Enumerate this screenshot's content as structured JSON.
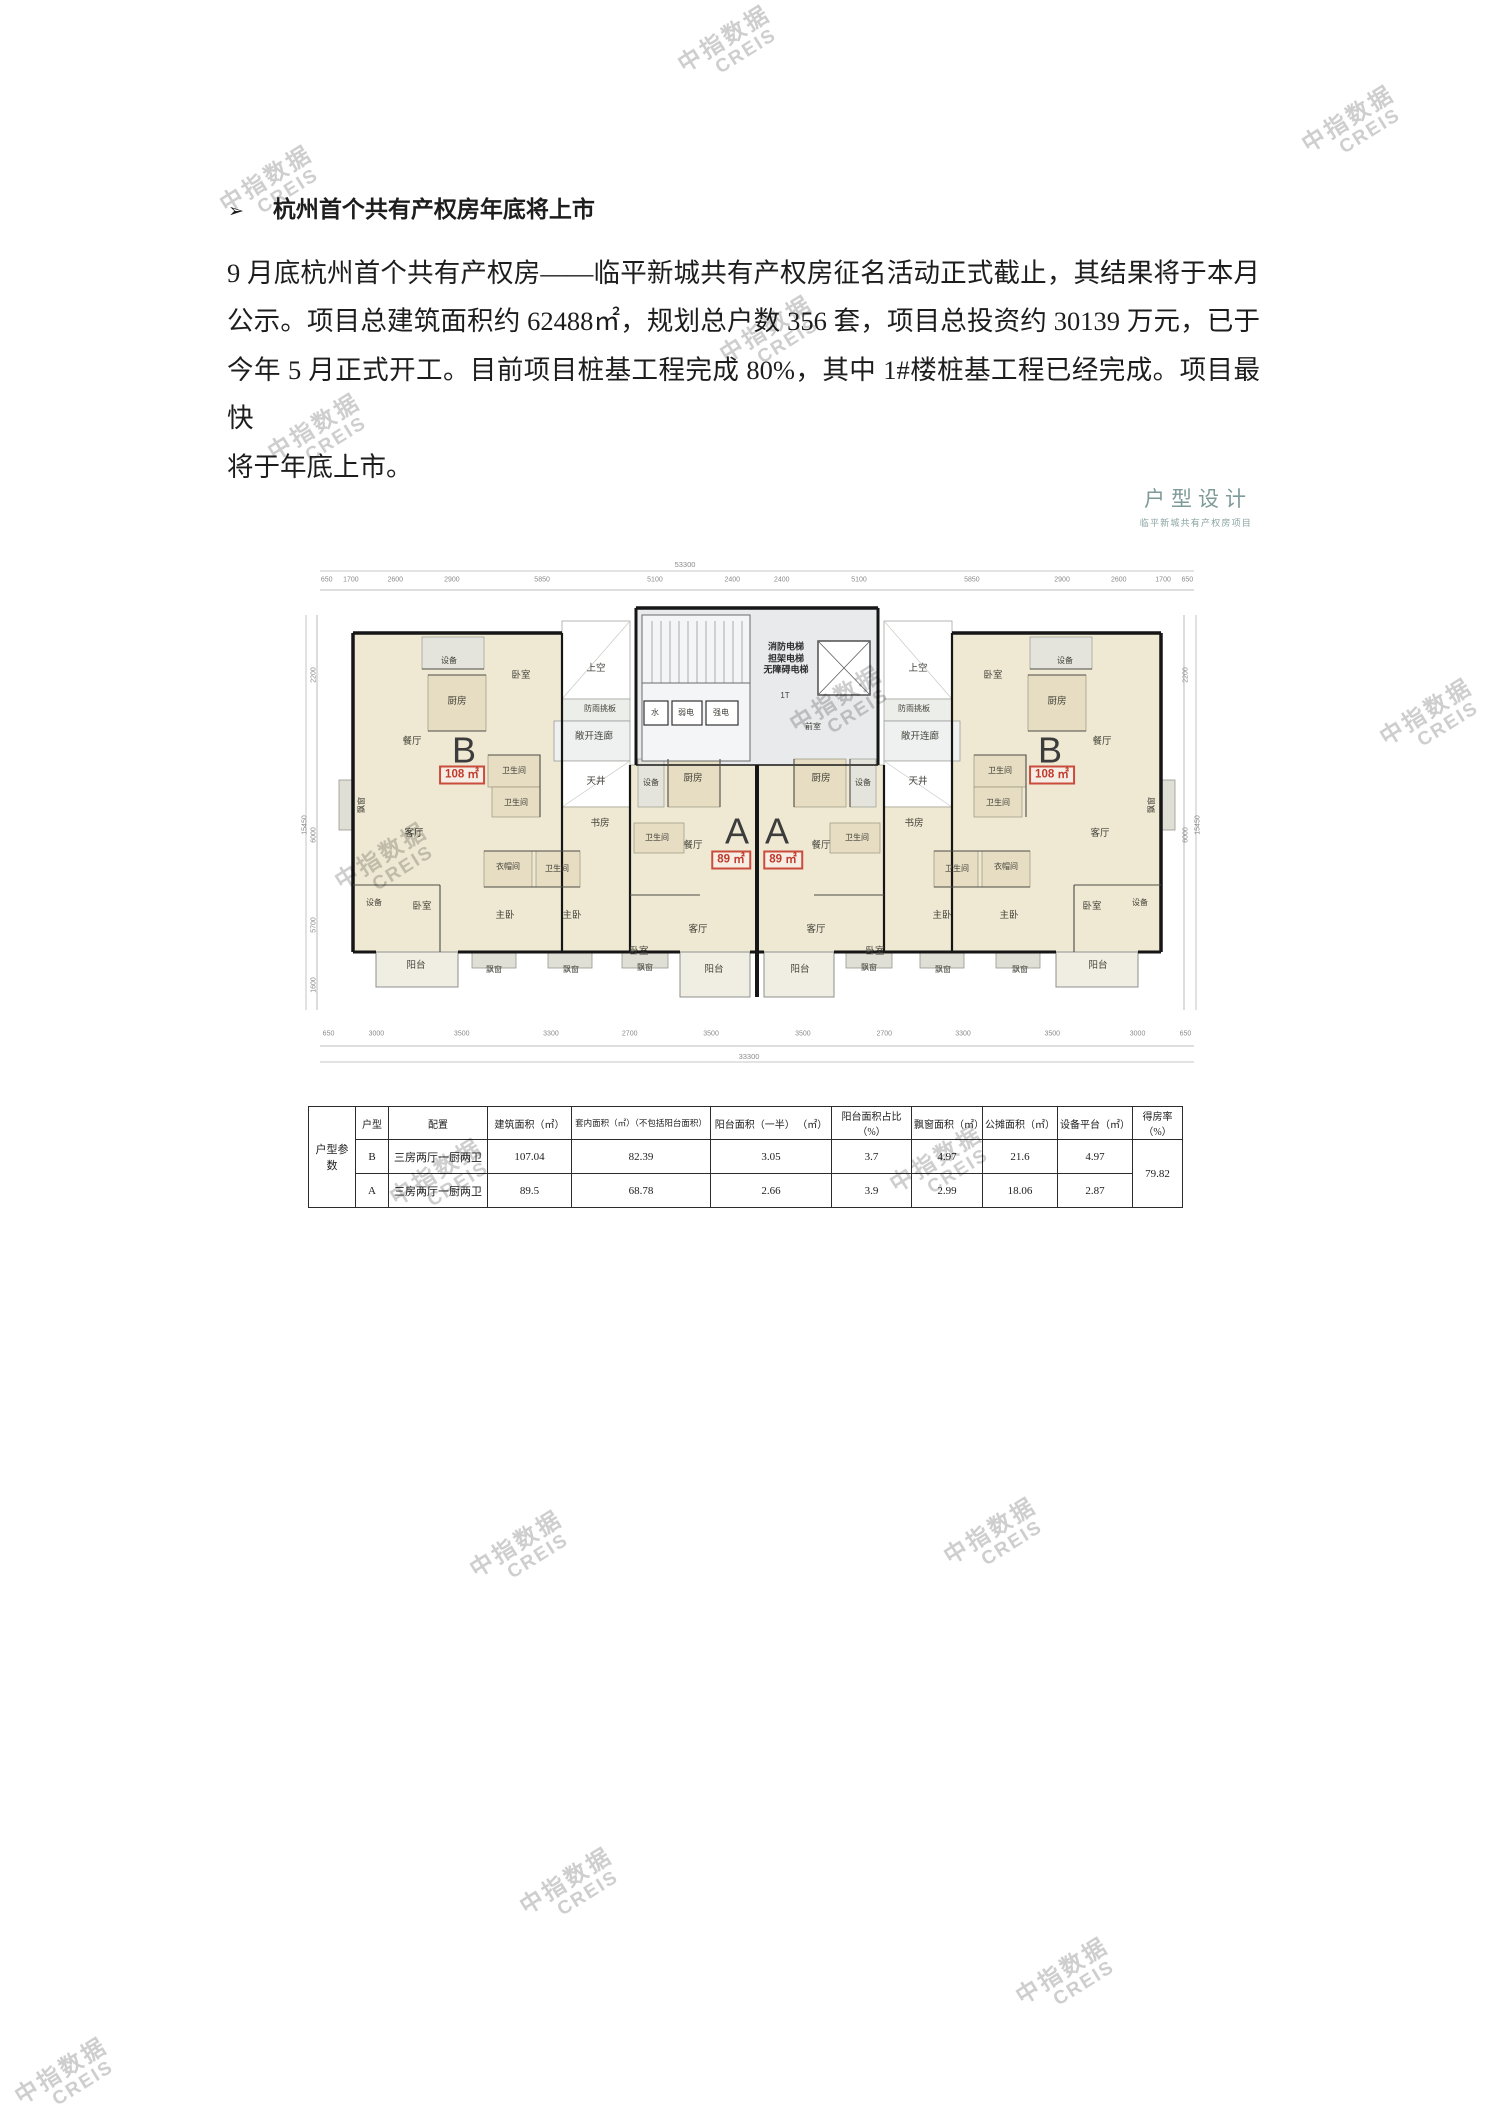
{
  "watermark": {
    "line1": "中指数据",
    "line2": "CREIS",
    "color": "#c6c6c6",
    "positions": [
      [
        728,
        45
      ],
      [
        1352,
        125
      ],
      [
        270,
        185
      ],
      [
        770,
        335
      ],
      [
        318,
        433
      ],
      [
        840,
        705
      ],
      [
        1430,
        718
      ],
      [
        385,
        862
      ],
      [
        -55,
        975
      ],
      [
        440,
        1178
      ],
      [
        940,
        1165
      ],
      [
        520,
        1550
      ],
      [
        -55,
        1592
      ],
      [
        994,
        1537
      ],
      [
        570,
        1887
      ],
      [
        1066,
        1977
      ],
      [
        65,
        2077
      ]
    ]
  },
  "heading": {
    "bullet": "➢",
    "text": "杭州首个共有产权房年底将上市"
  },
  "paragraph": {
    "lines": [
      "9 月底杭州首个共有产权房——临平新城共有产权房征名活动正式截止，其结果将于本月",
      "公示。项目总建筑面积约 62488㎡，规划总户数 356 套，项目总投资约 30139 万元，已于",
      "今年 5 月正式开工。目前项目桩基工程完成 80%，其中 1#楼桩基工程已经完成。项目最快",
      "将于年底上市。"
    ]
  },
  "floorplan": {
    "title": "户型设计",
    "subtitle": "临平新城共有产权房项目",
    "accent_color": "#7d9b99",
    "area_color": "#c0392b",
    "dims_top": {
      "segments": [
        "650",
        "1700",
        "2600",
        "2900",
        "5850",
        "5100",
        "2400",
        "2400",
        "5100",
        "5850",
        "2900",
        "2600",
        "1700",
        "650"
      ],
      "total": "53300"
    },
    "dims_bottom": {
      "segments": [
        "650",
        "3000",
        "3500",
        "3300",
        "2700",
        "3500",
        "3500",
        "2700",
        "3300",
        "3500",
        "3000",
        "650"
      ],
      "total": "33300"
    },
    "side_dims": [
      {
        "v": "2200",
        "x": 14,
        "y": 120
      },
      {
        "v": "6000",
        "x": 14,
        "y": 280
      },
      {
        "v": "5700",
        "x": 14,
        "y": 370
      },
      {
        "v": "1600",
        "x": 14,
        "y": 430
      },
      {
        "v": "15450",
        "x": 5,
        "y": 270
      },
      {
        "v": "2200",
        "x": 886,
        "y": 120
      },
      {
        "v": "6000",
        "x": 886,
        "y": 280
      },
      {
        "v": "15450",
        "x": 898,
        "y": 270
      }
    ],
    "units": [
      {
        "t": "B",
        "x": 164,
        "y": 196
      },
      {
        "t": "A",
        "x": 437,
        "y": 277
      },
      {
        "t": "A",
        "x": 477,
        "y": 277
      },
      {
        "t": "B",
        "x": 750,
        "y": 196
      }
    ],
    "area_boxes": [
      {
        "t": "108 ㎡",
        "x": 162,
        "y": 220
      },
      {
        "t": "89 ㎡",
        "x": 431,
        "y": 305
      },
      {
        "t": "89 ㎡",
        "x": 483,
        "y": 305
      },
      {
        "t": "108 ㎡",
        "x": 752,
        "y": 220
      }
    ],
    "labels": [
      {
        "t": "消防电梯\n担架电梯\n无障碍电梯",
        "x": 486,
        "y": 104,
        "c": "core"
      },
      {
        "t": "1T",
        "x": 485,
        "y": 141,
        "c": "sm"
      },
      {
        "t": "水",
        "x": 355,
        "y": 158,
        "c": "sm"
      },
      {
        "t": "弱电",
        "x": 386,
        "y": 158,
        "c": "sm"
      },
      {
        "t": "强电",
        "x": 421,
        "y": 158,
        "c": "sm"
      },
      {
        "t": "前室",
        "x": 513,
        "y": 172,
        "c": "sm"
      },
      {
        "t": "上空",
        "x": 296,
        "y": 114
      },
      {
        "t": "上空",
        "x": 618,
        "y": 114
      },
      {
        "t": "防雨挑板",
        "x": 300,
        "y": 154,
        "c": "sm"
      },
      {
        "t": "防雨挑板",
        "x": 614,
        "y": 154,
        "c": "sm"
      },
      {
        "t": "敞开连廊",
        "x": 294,
        "y": 182
      },
      {
        "t": "敞开连廊",
        "x": 620,
        "y": 182
      },
      {
        "t": "天井",
        "x": 296,
        "y": 227
      },
      {
        "t": "天井",
        "x": 618,
        "y": 227
      },
      {
        "t": "书房",
        "x": 300,
        "y": 269
      },
      {
        "t": "书房",
        "x": 614,
        "y": 269
      },
      {
        "t": "设备",
        "x": 149,
        "y": 106,
        "c": "sm"
      },
      {
        "t": "卧室",
        "x": 221,
        "y": 121
      },
      {
        "t": "厨房",
        "x": 157,
        "y": 147
      },
      {
        "t": "餐厅",
        "x": 112,
        "y": 187
      },
      {
        "t": "卫生间",
        "x": 214,
        "y": 216,
        "c": "sm"
      },
      {
        "t": "卫生间",
        "x": 216,
        "y": 248,
        "c": "sm"
      },
      {
        "t": "客厅",
        "x": 114,
        "y": 279
      },
      {
        "t": "衣帽间",
        "x": 208,
        "y": 312,
        "c": "sm"
      },
      {
        "t": "卫生间",
        "x": 257,
        "y": 314,
        "c": "sm"
      },
      {
        "t": "设备",
        "x": 74,
        "y": 348,
        "c": "sm"
      },
      {
        "t": "卧室",
        "x": 122,
        "y": 352
      },
      {
        "t": "主卧",
        "x": 205,
        "y": 361
      },
      {
        "t": "主卧",
        "x": 272,
        "y": 361
      },
      {
        "t": "阳台",
        "x": 116,
        "y": 411
      },
      {
        "t": "飘窗",
        "x": 194,
        "y": 415,
        "c": "sm"
      },
      {
        "t": "飘窗",
        "x": 271,
        "y": 415,
        "c": "sm"
      },
      {
        "t": "飘窗",
        "x": 62,
        "y": 250,
        "c": "sm vert"
      },
      {
        "t": "设备",
        "x": 765,
        "y": 106,
        "c": "sm"
      },
      {
        "t": "卧室",
        "x": 693,
        "y": 121
      },
      {
        "t": "厨房",
        "x": 757,
        "y": 147
      },
      {
        "t": "餐厅",
        "x": 802,
        "y": 187
      },
      {
        "t": "卫生间",
        "x": 700,
        "y": 216,
        "c": "sm"
      },
      {
        "t": "卫生间",
        "x": 698,
        "y": 248,
        "c": "sm"
      },
      {
        "t": "客厅",
        "x": 800,
        "y": 279
      },
      {
        "t": "衣帽间",
        "x": 706,
        "y": 312,
        "c": "sm"
      },
      {
        "t": "卫生间",
        "x": 657,
        "y": 314,
        "c": "sm"
      },
      {
        "t": "设备",
        "x": 840,
        "y": 348,
        "c": "sm"
      },
      {
        "t": "卧室",
        "x": 792,
        "y": 352
      },
      {
        "t": "主卧",
        "x": 709,
        "y": 361
      },
      {
        "t": "主卧",
        "x": 642,
        "y": 361
      },
      {
        "t": "阳台",
        "x": 798,
        "y": 411
      },
      {
        "t": "飘窗",
        "x": 720,
        "y": 415,
        "c": "sm"
      },
      {
        "t": "飘窗",
        "x": 643,
        "y": 415,
        "c": "sm"
      },
      {
        "t": "飘窗",
        "x": 852,
        "y": 250,
        "c": "sm vert"
      },
      {
        "t": "设备",
        "x": 351,
        "y": 228,
        "c": "sm"
      },
      {
        "t": "厨房",
        "x": 393,
        "y": 224
      },
      {
        "t": "卫生间",
        "x": 357,
        "y": 283,
        "c": "sm"
      },
      {
        "t": "餐厅",
        "x": 393,
        "y": 291
      },
      {
        "t": "客厅",
        "x": 398,
        "y": 375
      },
      {
        "t": "卧室",
        "x": 339,
        "y": 397
      },
      {
        "t": "阳台",
        "x": 414,
        "y": 415
      },
      {
        "t": "飘窗",
        "x": 345,
        "y": 413,
        "c": "sm"
      },
      {
        "t": "设备",
        "x": 563,
        "y": 228,
        "c": "sm"
      },
      {
        "t": "厨房",
        "x": 521,
        "y": 224
      },
      {
        "t": "卫生间",
        "x": 557,
        "y": 283,
        "c": "sm"
      },
      {
        "t": "餐厅",
        "x": 521,
        "y": 291
      },
      {
        "t": "客厅",
        "x": 516,
        "y": 375
      },
      {
        "t": "卧室",
        "x": 575,
        "y": 397
      },
      {
        "t": "阳台",
        "x": 500,
        "y": 415
      },
      {
        "t": "飘窗",
        "x": 569,
        "y": 413,
        "c": "sm"
      }
    ]
  },
  "table": {
    "group_label": "户型参数",
    "headers": [
      "户型",
      "配置",
      "建筑面积（㎡）",
      "套内面积（㎡）（不包括阳台面积）",
      "阳台面积（一半）  （㎡）",
      "阳台面积占比（%）",
      "飘窗面积（㎡）",
      "公摊面积（㎡）",
      "设备平台（㎡）",
      "得房率（%）"
    ],
    "rows": [
      {
        "cells": [
          "B",
          "三房两厅一厨两卫",
          "107.04",
          "82.39",
          "3.05",
          "3.7",
          "4.97",
          "21.6",
          "4.97"
        ]
      },
      {
        "cells": [
          "A",
          "三房两厅一厨两卫",
          "89.5",
          "68.78",
          "2.66",
          "3.9",
          "2.99",
          "18.06",
          "2.87"
        ]
      }
    ],
    "merged_value": "79.82"
  }
}
